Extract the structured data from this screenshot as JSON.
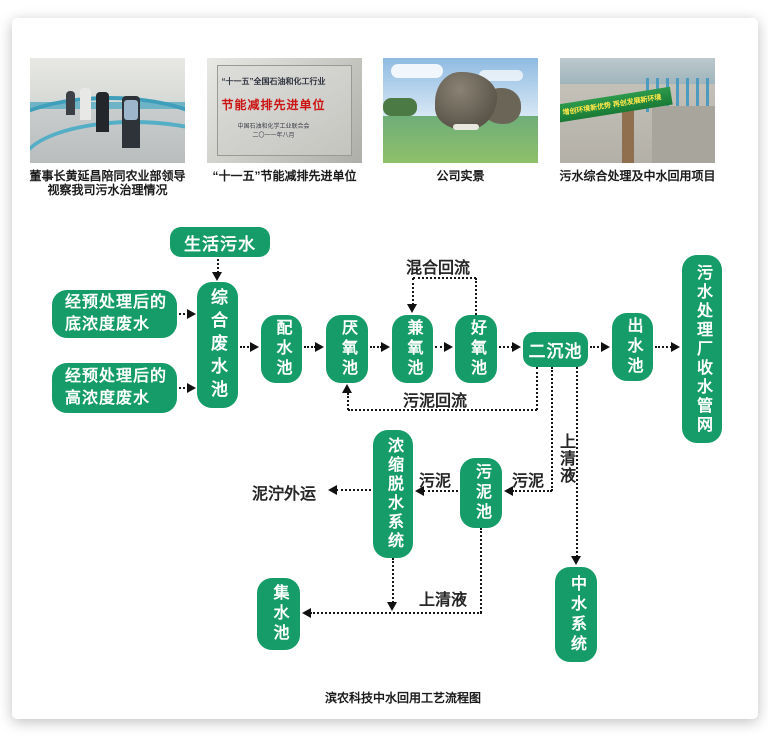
{
  "colors": {
    "node_green": "#169c68",
    "node_text": "#ffffff",
    "line": "#161616",
    "label_text": "#262626",
    "plaque_red": "#cc1512",
    "banner_green": "#197a35",
    "banner_yellow": "#ffe84a"
  },
  "photos": [
    {
      "caption_lines": [
        "董事长黄延昌陪同农业部领导",
        "视察我司污水治理情况"
      ]
    },
    {
      "caption_lines": [
        "“十一五”节能减排先进单位"
      ],
      "plaque": {
        "header": "“十一五”全国石油和化工行业",
        "title": "节能减排先进单位",
        "issuer": "中国石油和化学工业联合会",
        "date": "二〇一一年八月"
      }
    },
    {
      "caption_lines": [
        "公司实景"
      ]
    },
    {
      "caption_lines": [
        "污水综合处理及中水回用项目"
      ],
      "banner": "增创环境新优势 再创发展新环境"
    }
  ],
  "flowchart": {
    "nodes": {
      "domestic_sewage": "生活污水",
      "low_conc": "经预处理后的\n底浓度废水",
      "high_conc": "经预处理后的\n高浓度废水",
      "comprehensive_pool": "综合废水池",
      "distribution_pool": "配水池",
      "anaerobic_pool": "厌氧池",
      "facultative_pool": "兼氧池",
      "aerobic_pool": "好氧池",
      "secondary_sedimentation": "二沉池",
      "effluent_pool": "出水池",
      "collection_network": "污水处理厂收水管网",
      "dewatering_system": "浓缩脱水系统",
      "sludge_pool": "污泥池",
      "reclaimed_water_system": "中水系统",
      "collecting_pool": "集水池"
    },
    "labels": {
      "mixed_reflux": "混合回流",
      "sludge_reflux": "污泥回流",
      "sludge_a": "污泥",
      "sludge_b": "污泥",
      "supernatant_v": "上清液",
      "supernatant_h": "上清液",
      "mud_transport": "泥泞外运"
    },
    "caption": "滨农科技中水回用工艺流程图"
  }
}
